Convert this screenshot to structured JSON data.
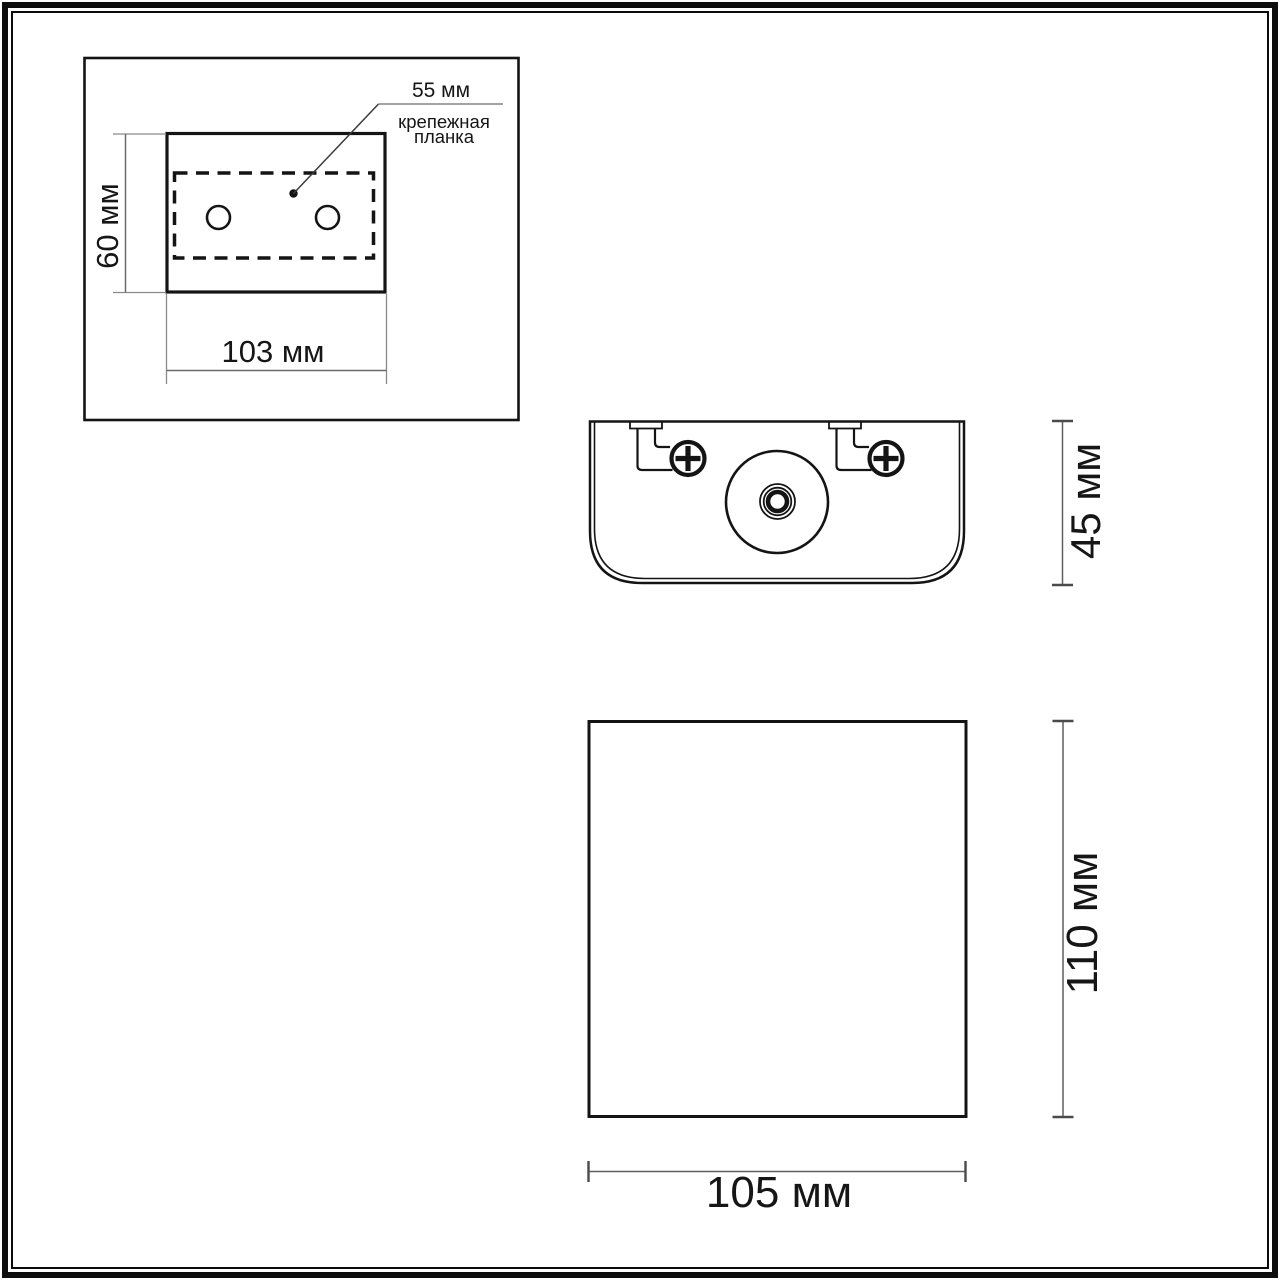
{
  "drawing": {
    "title_semantic": "wall-lamp dimensional drawing",
    "mounting_plate_view": {
      "hole_spacing_label": "55 мм",
      "callout": {
        "line1": "крепежная",
        "line2": "планка"
      },
      "height_label": "60 мм",
      "width_label": "103 мм"
    },
    "top_view": {
      "height_label": "45 мм"
    },
    "front_view": {
      "height_label": "110 мм",
      "width_label": "105 мм"
    }
  },
  "colors": {
    "line": "#141414",
    "dimension_line": "#666666",
    "extension_line": "#8a8a8a",
    "background": "#ffffff"
  }
}
